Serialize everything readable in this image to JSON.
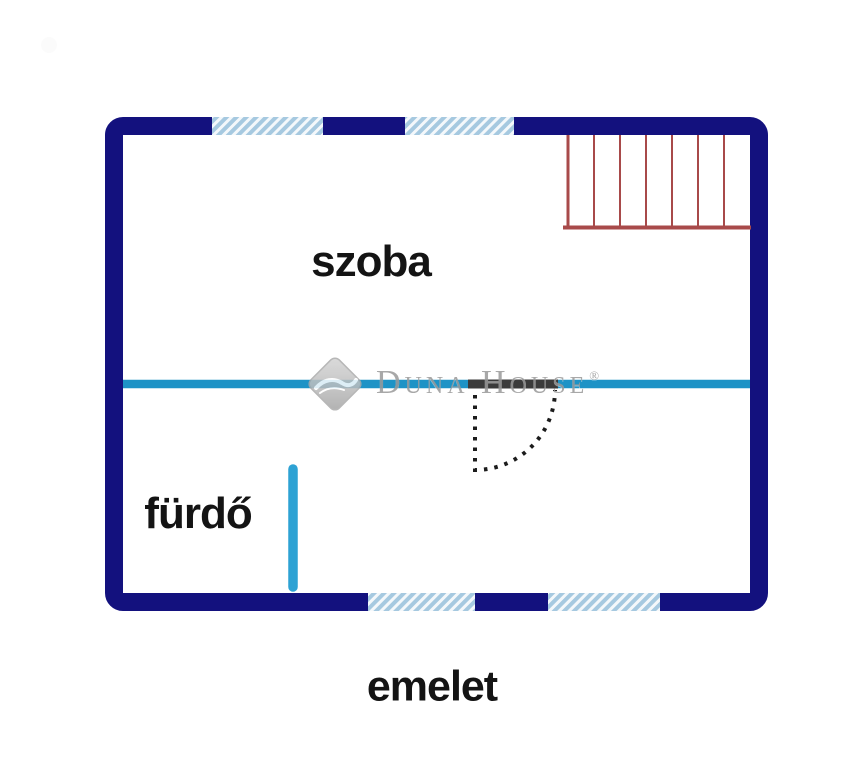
{
  "floor_plan": {
    "rooms": [
      {
        "name": "szoba"
      },
      {
        "name": "fürdő"
      }
    ],
    "floor_label": "emelet",
    "watermark": {
      "brand": "Duna House",
      "registered": "®"
    },
    "features": {
      "staircase": "stairs-top-right",
      "door": "quarter-swing-door",
      "windows_top": 2,
      "windows_bottom": 2
    },
    "colors": {
      "wall": "#13117e",
      "window_fill": "#a6c9e0",
      "window_stripe": "#f4f8fb",
      "stairs": "#a84a4a",
      "divider": "#1e93c6",
      "divider_vertical": "#2da2d4",
      "door": "#3b3b3b",
      "door_swing": "#1c1c1c",
      "label_text": "#141414",
      "watermark": "#9a9a9a"
    }
  }
}
